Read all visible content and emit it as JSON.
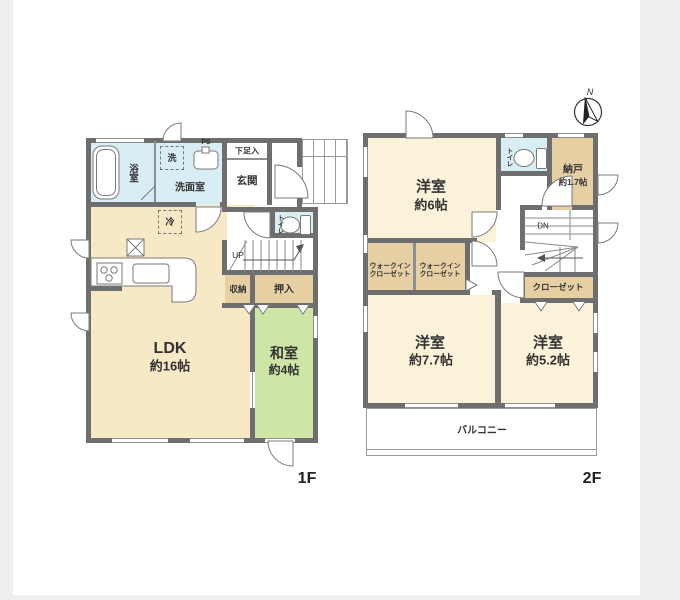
{
  "colors": {
    "wall": "#6e6e6e",
    "ldk_cream": "#f7e8c6",
    "bedroom_cream": "#faf3da",
    "closet_tan": "#e5cfa3",
    "tatami_green": "#cfe5a6",
    "water_blue": "#d9edf4"
  },
  "floor1": {
    "floor_label": "1F",
    "bath": "浴室",
    "washer": "洗",
    "ps": "PS",
    "washroom": "洗面室",
    "shoe_cabinet": "下足入",
    "entrance": "玄関",
    "toilet": "トイレ",
    "up": "UP",
    "fridge": "冷",
    "storage": "収納",
    "oshiire": "押入",
    "ldk": "LDK",
    "ldk_size": "約16帖",
    "washitsu": "和室",
    "washitsu_size": "約4帖"
  },
  "floor2": {
    "floor_label": "2F",
    "room6": "洋室",
    "room6_size": "約6帖",
    "toilet": "トイレ",
    "nando": "納戸",
    "nando_size": "約1.7帖",
    "dn": "DN",
    "wic1_line1": "ウォークイン",
    "wic1_line2": "クローゼット",
    "wic2_line1": "ウォークイン",
    "wic2_line2": "クローゼット",
    "closet": "クローゼット",
    "room77": "洋室",
    "room77_size": "約7.7帖",
    "room52": "洋室",
    "room52_size": "約5.2帖",
    "balcony": "バルコニー",
    "compass_n": "N"
  }
}
